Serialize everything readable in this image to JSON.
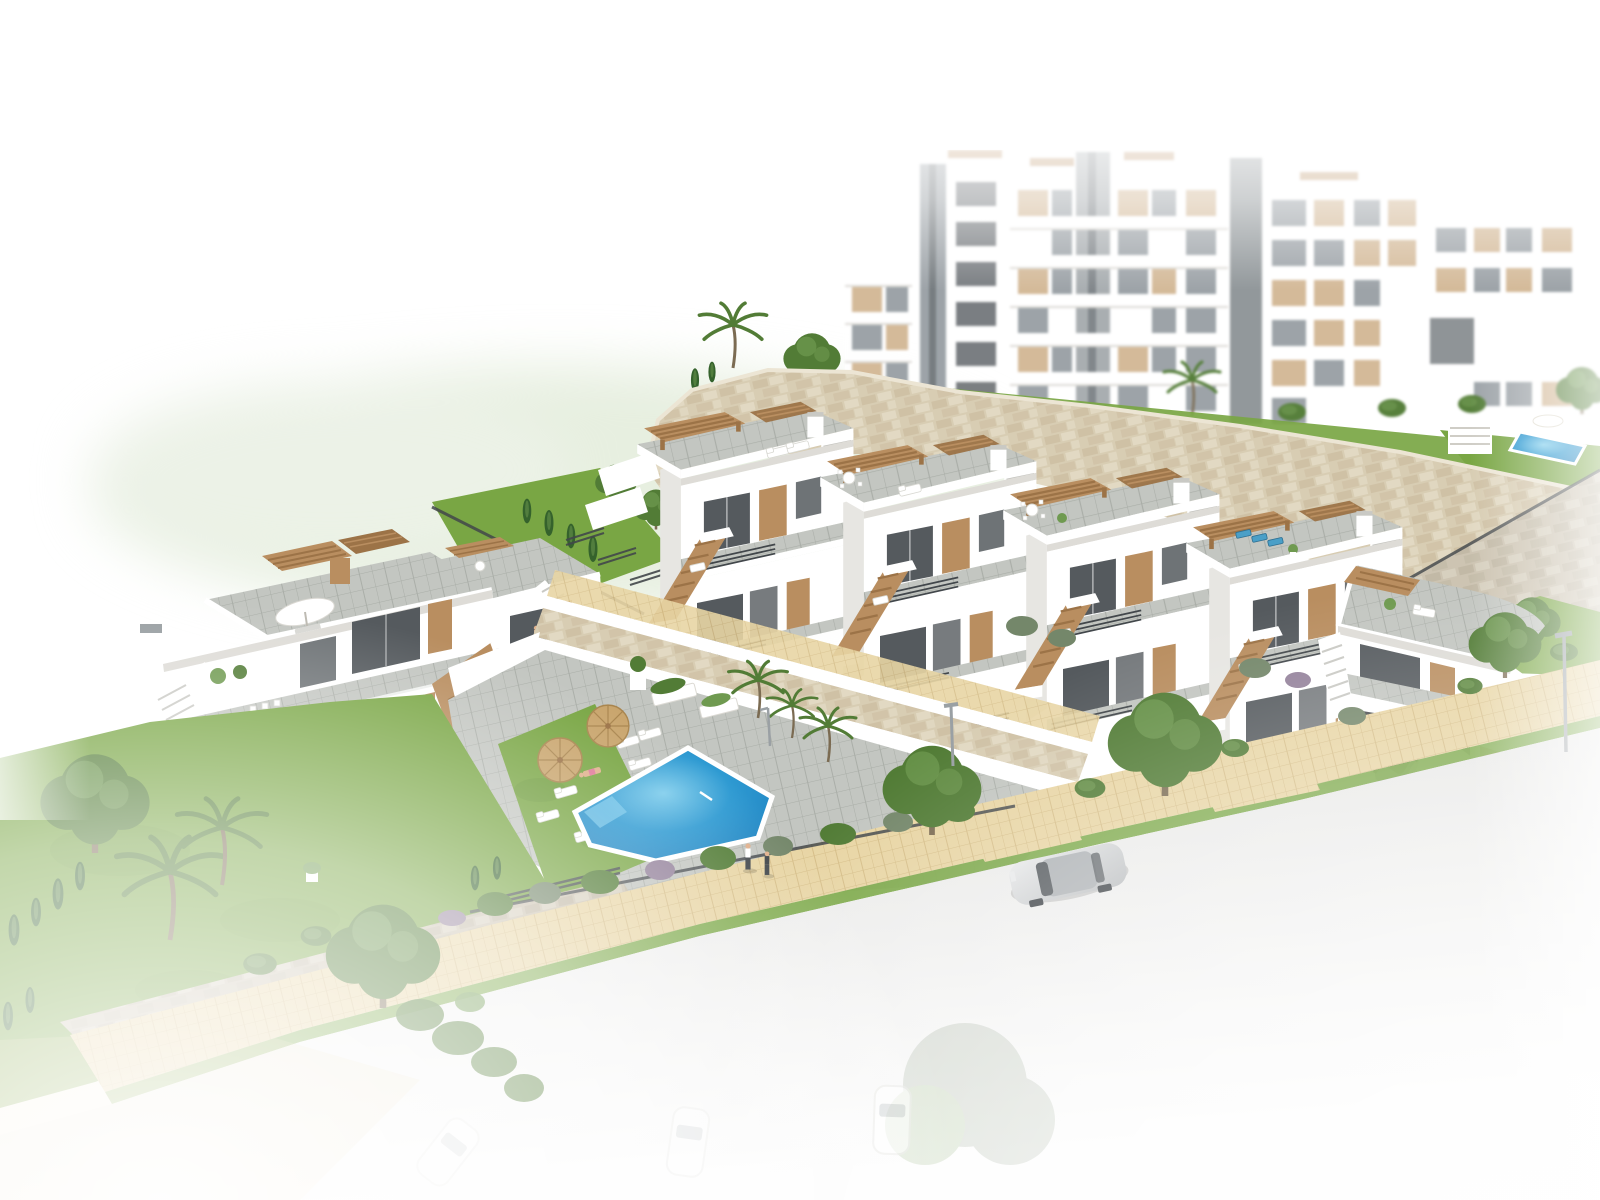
{
  "image": {
    "title": "New-build residential development - aerial 3D architectural render",
    "alt": "Aerial architectural rendering of a white Mediterranean-style residential development: a stepped row of five modern townhouses with roof terraces and timber pergolas on a hillside, a two-storey villa block on the left, a communal swimming pool with sun loungers and straw parasols, multi-storey apartment buildings behind beige stone retaining walls, landscaped gardens with palms and cypress hedges, a sandy paved footpath and a street with parked cars fading to white at the edges."
  },
  "palette": {
    "white": "#ffffff",
    "hill": "#dfe9d5",
    "bldg-side": "#e7e6e2",
    "bldg-shade": "#dcdbd6",
    "glass-dark": "#555a5e",
    "glass-mid": "#9aa1a6",
    "tan": "#d3b896",
    "wood": "#b98e60",
    "wood-dark": "#9c7347",
    "rail": "#42474b",
    "stone": "#d8cdb3",
    "stone-dark": "#c3b294",
    "stone-cap": "#ece5d4",
    "stone-gray": "#cdc4b2",
    "deck": "#c3c6c1",
    "deck-line": "#aaaea8",
    "sand": "#e8d5a4",
    "sand-line": "#d5bd87",
    "grass": "#79a644",
    "grass-dark": "#5e8c32",
    "tree1": "#527c36",
    "tree2": "#6f9a50",
    "cypress": "#35622c",
    "bush-gray": "#74876a",
    "bush-purple": "#94829b",
    "pool": "#2e9ad2",
    "pool-deep": "#1d7fbe",
    "pool-light": "#7fcdec",
    "straw": "#c9a56d",
    "straw-dark": "#a9854e",
    "road": "#efefee",
    "road-edge": "#e2e2e0",
    "concrete": "#e6e5e1",
    "car-silver": "#cfd0d1",
    "car-gray": "#8f9296",
    "car-dark": "#3e4347",
    "trunk": "#7b6b52",
    "skin": "#e0b08c",
    "accent-pink": "#e07a9a",
    "lamp": "#9aa0a4"
  },
  "scene": {
    "apartment_complex": {
      "blocks": 4,
      "storeys_max": 6,
      "features": [
        "white facades",
        "beige window panels",
        "grey lift towers",
        "roof pergolas",
        "balconies"
      ]
    },
    "townhouse_row": {
      "units": 5,
      "features": [
        "roof terraces",
        "timber pergolas",
        "external tan staircases",
        "dark slatted fences"
      ],
      "roof_furniture": [
        "white loungers",
        "dining set",
        "dining set",
        "blue loungers",
        "plant pots"
      ]
    },
    "villa_block": {
      "units": 2,
      "features": [
        "roof terrace with twin pergolas",
        "white parasol with loungers",
        "terrace dining set",
        "external stairs",
        "chimney"
      ]
    },
    "pool_area": {
      "pool": "communal swimming pool",
      "loungers": 7,
      "parasols": 2,
      "planters": 3,
      "benches": 2,
      "outdoor_shower": 1,
      "sunbather": 1
    },
    "street": {
      "parked_cars_visible": [
        "silver sedan",
        "grey sports car at garage"
      ],
      "faded_cars": 3,
      "pedestrians": 2,
      "street_lamps": 2,
      "sidewalk": "sand-coloured pavers with grass verges"
    },
    "landscaping": {
      "retaining_walls": "beige natural stone",
      "gardens": [
        "lawns",
        "cypress hedges",
        "palm trees",
        "round trees",
        "flowering shrubs"
      ],
      "upper_garden_pools": 2
    }
  }
}
